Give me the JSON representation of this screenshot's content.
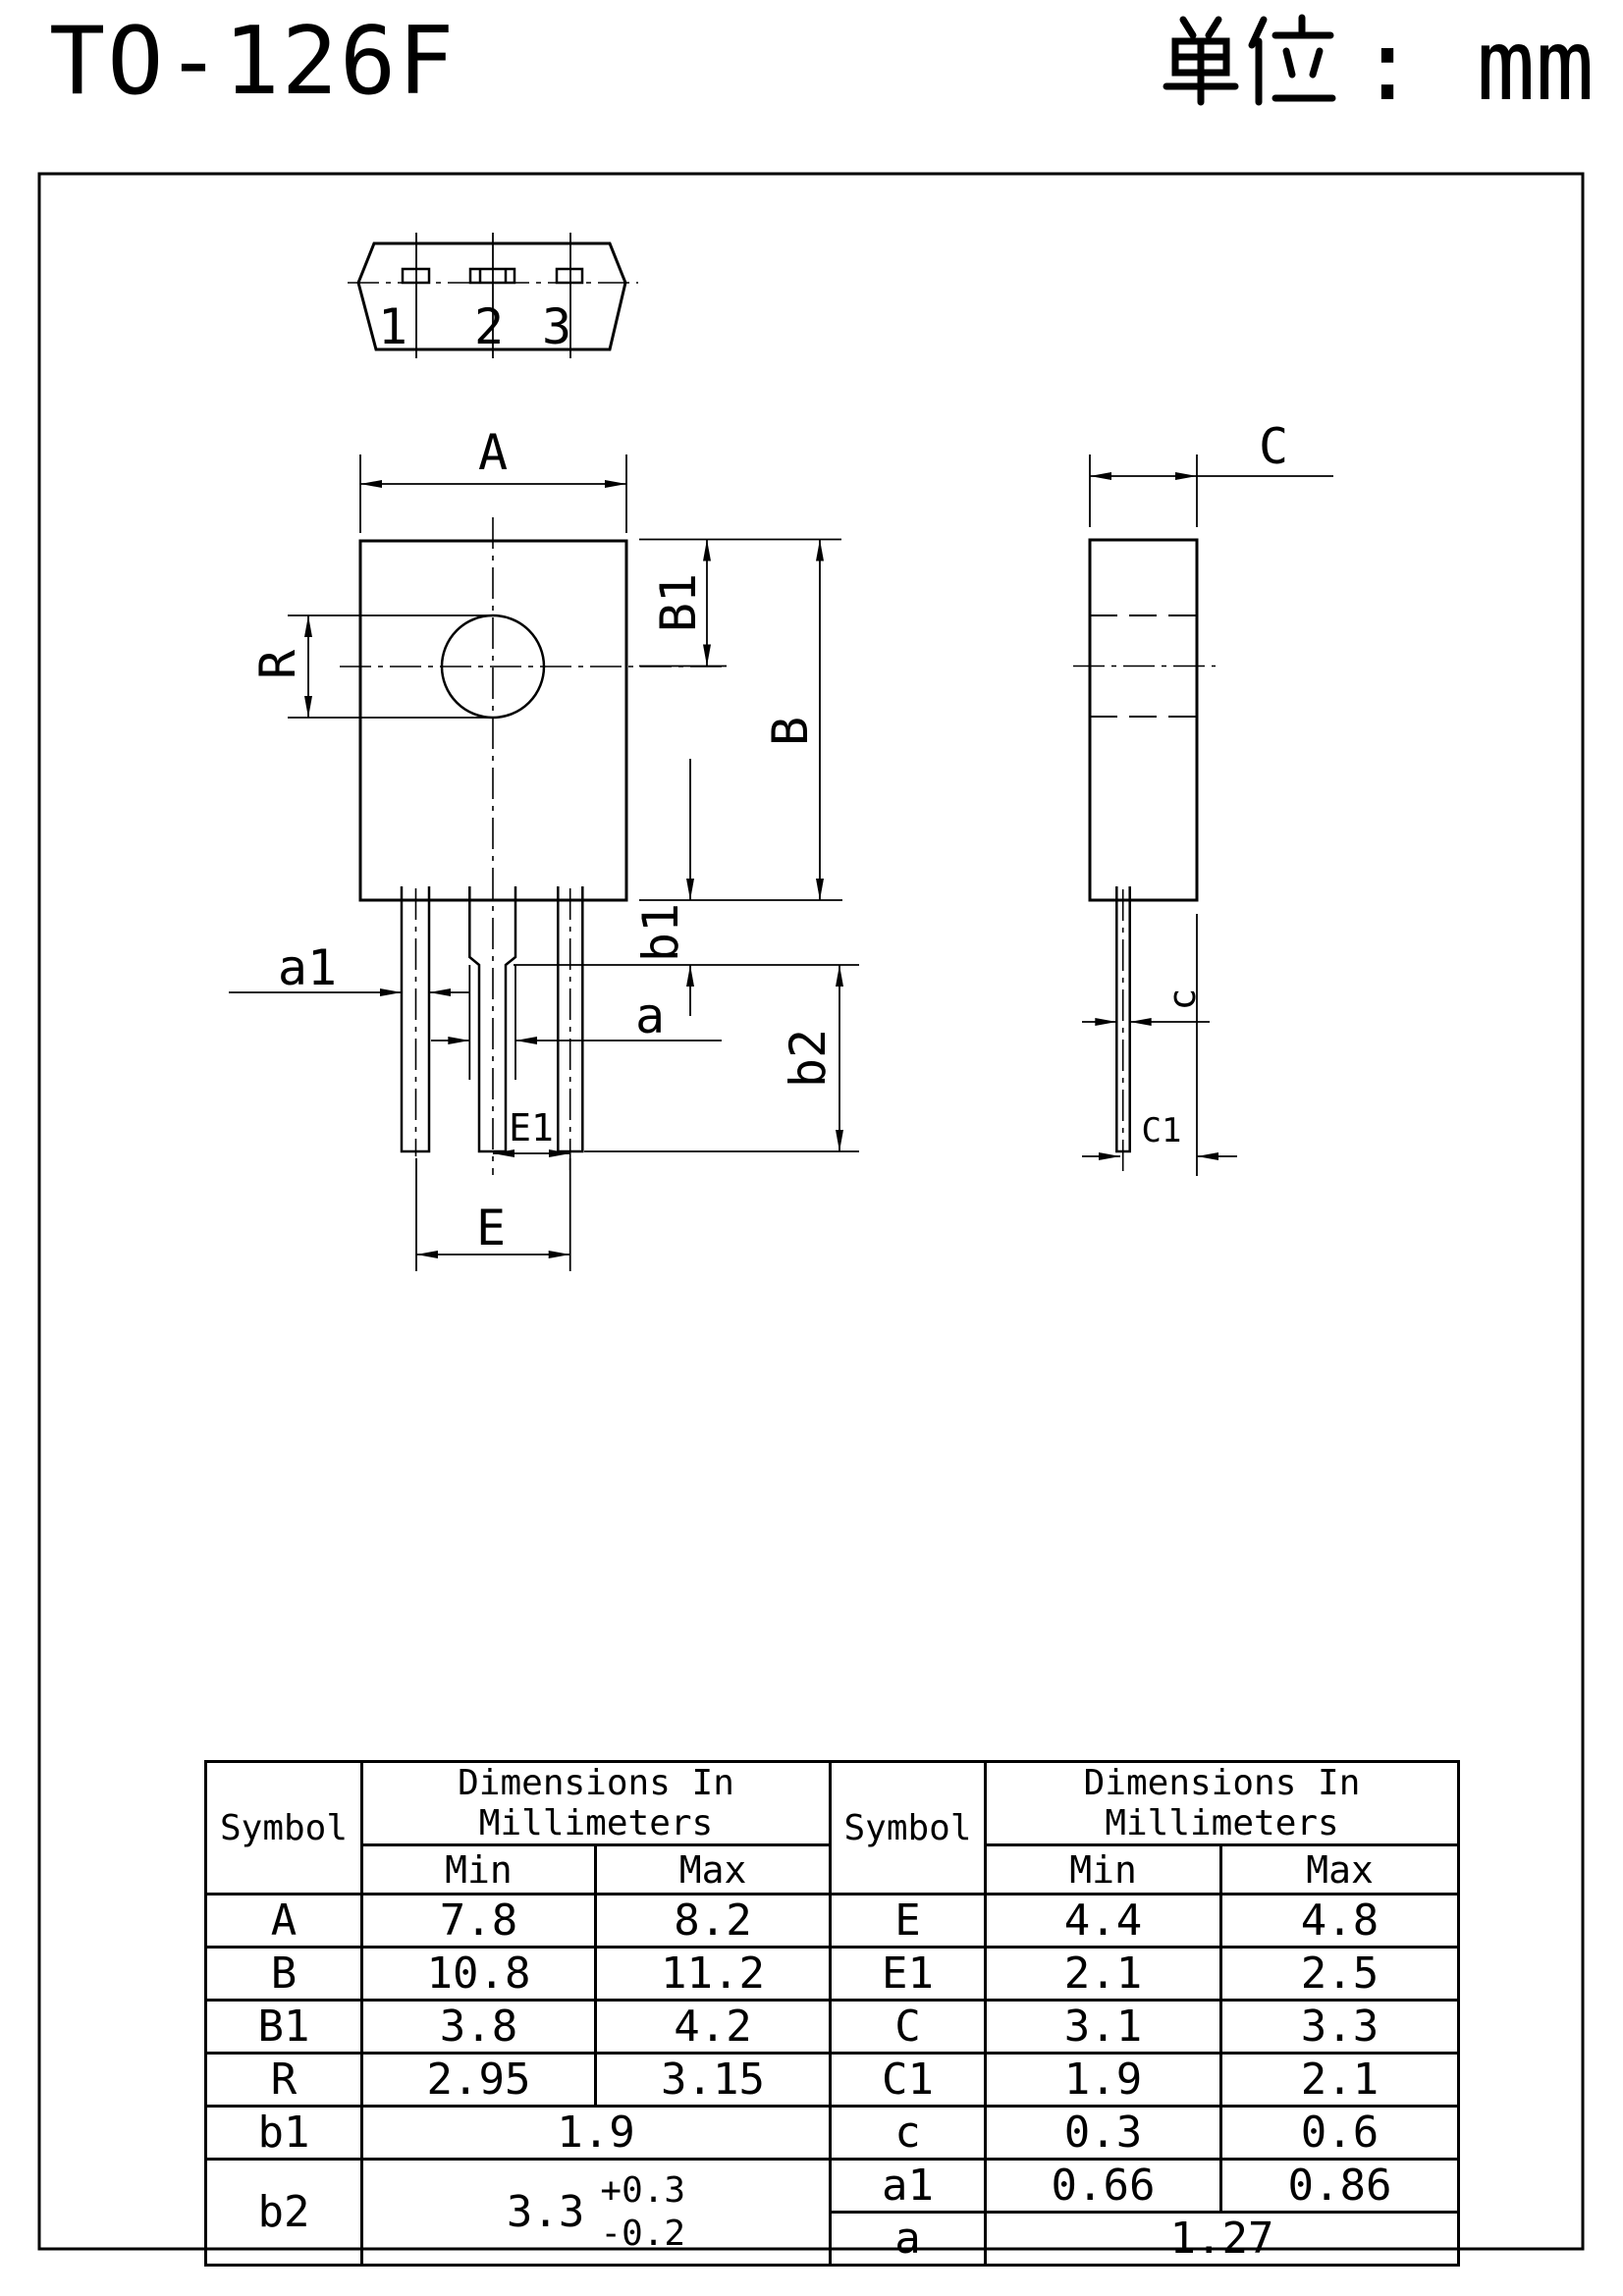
{
  "header": {
    "title": "TO-126F",
    "unit_prefix": "单位",
    "unit_separator": ":",
    "unit_value": "mm"
  },
  "drawing": {
    "pins": [
      "1",
      "2",
      "3"
    ],
    "labels": {
      "A": "A",
      "B": "B",
      "B1": "B1",
      "R": "R",
      "b1": "b1",
      "b2": "b2",
      "a1": "a1",
      "a": "a",
      "E": "E",
      "E1": "E1",
      "C": "C",
      "C1": "C1",
      "c": "c"
    }
  },
  "table": {
    "left": {
      "symbol_header": "Symbol",
      "dim_header": "Dimensions In Millimeters",
      "min_header": "Min",
      "max_header": "Max",
      "rows": [
        {
          "symbol": "A",
          "min": "7.8",
          "max": "8.2"
        },
        {
          "symbol": "B",
          "min": "10.8",
          "max": "11.2"
        },
        {
          "symbol": "B1",
          "min": "3.8",
          "max": "4.2"
        },
        {
          "symbol": "R",
          "min": "2.95",
          "max": "3.15"
        },
        {
          "symbol": "b1",
          "value": "1.9"
        },
        {
          "symbol": "b2",
          "value": "3.3",
          "tol_plus": "+0.3",
          "tol_minus": "-0.2"
        }
      ]
    },
    "right": {
      "symbol_header": "Symbol",
      "dim_header": "Dimensions In Millimeters",
      "min_header": "Min",
      "max_header": "Max",
      "rows": [
        {
          "symbol": "E",
          "min": "4.4",
          "max": "4.8"
        },
        {
          "symbol": "E1",
          "min": "2.1",
          "max": "2.5"
        },
        {
          "symbol": "C",
          "min": "3.1",
          "max": "3.3"
        },
        {
          "symbol": "C1",
          "min": "1.9",
          "max": "2.1"
        },
        {
          "symbol": "c",
          "min": "0.3",
          "max": "0.6"
        },
        {
          "symbol": "a1",
          "min": "0.66",
          "max": "0.86"
        },
        {
          "symbol": "a",
          "value": "1.27"
        }
      ]
    }
  }
}
